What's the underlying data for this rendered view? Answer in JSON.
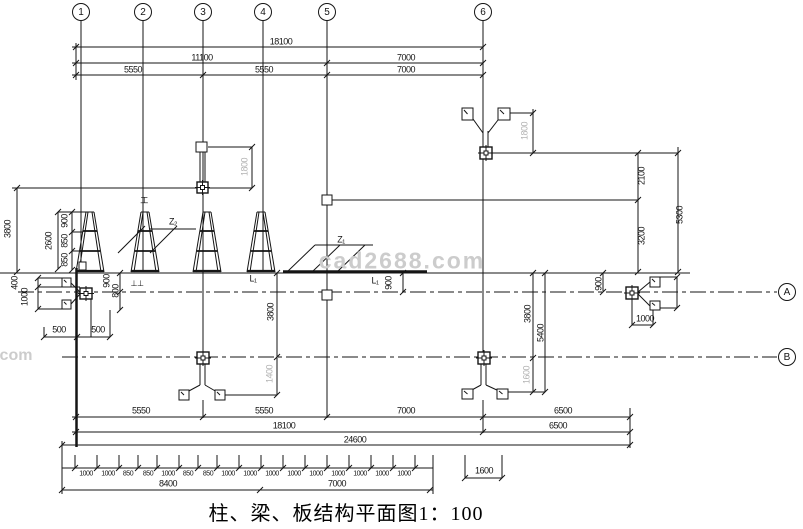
{
  "drawing_title": {
    "text": "柱、梁、板结构平面图1：100"
  },
  "watermark": {
    "main": "cad2688.com",
    "corner": "com"
  },
  "colors": {
    "line": "#151515",
    "dim_text": "#151515",
    "faint_dim_text": "#b3b3b3",
    "watermark": "#cccccc"
  },
  "grid": {
    "columns": [
      {
        "label": "1",
        "x": 81
      },
      {
        "label": "2",
        "x": 143
      },
      {
        "label": "3",
        "x": 203
      },
      {
        "label": "4",
        "x": 263
      },
      {
        "label": "5",
        "x": 327
      },
      {
        "label": "6",
        "x": 483
      }
    ],
    "rows": [
      {
        "label": "A",
        "y": 292
      },
      {
        "label": "B",
        "y": 357
      }
    ]
  },
  "dimension_labels": [
    {
      "t": "18100",
      "x": 281,
      "y": 42
    },
    {
      "t": "11100",
      "x": 202,
      "y": 58
    },
    {
      "t": "7000",
      "x": 406,
      "y": 58
    },
    {
      "t": "5550",
      "x": 133,
      "y": 70
    },
    {
      "t": "5550",
      "x": 264,
      "y": 70
    },
    {
      "t": "7000",
      "x": 406,
      "y": 70
    },
    {
      "t": "2100",
      "x": 642,
      "y": 176,
      "r": 1
    },
    {
      "t": "3200",
      "x": 642,
      "y": 236,
      "r": 1
    },
    {
      "t": "5300",
      "x": 680,
      "y": 215,
      "r": 1
    },
    {
      "t": "1800",
      "x": 525,
      "y": 131,
      "r": 1,
      "c": "gray"
    },
    {
      "t": "1800",
      "x": 245,
      "y": 167,
      "r": 1,
      "c": "gray"
    },
    {
      "t": "3800",
      "x": 8,
      "y": 229,
      "r": 1
    },
    {
      "t": "2600",
      "x": 49,
      "y": 241,
      "r": 1
    },
    {
      "t": "900",
      "x": 65,
      "y": 221,
      "r": 1
    },
    {
      "t": "850",
      "x": 65,
      "y": 241,
      "r": 1
    },
    {
      "t": "850",
      "x": 65,
      "y": 260,
      "r": 1
    },
    {
      "t": "400",
      "x": 15,
      "y": 283,
      "r": 1
    },
    {
      "t": "1000",
      "x": 25,
      "y": 297,
      "r": 1
    },
    {
      "t": "900",
      "x": 107,
      "y": 281,
      "r": 1
    },
    {
      "t": "800",
      "x": 116,
      "y": 291,
      "r": 1
    },
    {
      "t": "500",
      "x": 59,
      "y": 330
    },
    {
      "t": "500",
      "x": 98,
      "y": 330
    },
    {
      "t": "900",
      "x": 389,
      "y": 283,
      "r": 1
    },
    {
      "t": "3800",
      "x": 271,
      "y": 312,
      "r": 1
    },
    {
      "t": "1400",
      "x": 270,
      "y": 374,
      "r": 1,
      "c": "gray"
    },
    {
      "t": "3800",
      "x": 528,
      "y": 314,
      "r": 1
    },
    {
      "t": "5400",
      "x": 541,
      "y": 333,
      "r": 1
    },
    {
      "t": "1600",
      "x": 527,
      "y": 375,
      "r": 1,
      "c": "gray"
    },
    {
      "t": "900",
      "x": 599,
      "y": 284,
      "r": 1
    },
    {
      "t": "1000",
      "x": 645,
      "y": 319
    },
    {
      "t": "5550",
      "x": 141,
      "y": 411
    },
    {
      "t": "5550",
      "x": 264,
      "y": 411
    },
    {
      "t": "7000",
      "x": 406,
      "y": 411
    },
    {
      "t": "6500",
      "x": 563,
      "y": 411
    },
    {
      "t": "18100",
      "x": 284,
      "y": 426
    },
    {
      "t": "6500",
      "x": 558,
      "y": 426
    },
    {
      "t": "24600",
      "x": 355,
      "y": 440
    },
    {
      "t": "8400",
      "x": 168,
      "y": 484
    },
    {
      "t": "7000",
      "x": 337,
      "y": 484
    },
    {
      "t": "1600",
      "x": 484,
      "y": 471
    },
    {
      "t": "1000",
      "x": 86,
      "y": 474,
      "s": 7
    },
    {
      "t": "1000",
      "x": 108,
      "y": 474,
      "s": 7
    },
    {
      "t": "850",
      "x": 128,
      "y": 474,
      "s": 7
    },
    {
      "t": "850",
      "x": 148,
      "y": 474,
      "s": 7
    },
    {
      "t": "1000",
      "x": 168,
      "y": 474,
      "s": 7
    },
    {
      "t": "850",
      "x": 188,
      "y": 474,
      "s": 7
    },
    {
      "t": "850",
      "x": 208,
      "y": 474,
      "s": 7
    },
    {
      "t": "1000",
      "x": 228,
      "y": 474,
      "s": 7
    },
    {
      "t": "1000",
      "x": 250,
      "y": 474,
      "s": 7
    },
    {
      "t": "1000",
      "x": 272,
      "y": 474,
      "s": 7
    },
    {
      "t": "1000",
      "x": 294,
      "y": 474,
      "s": 7
    },
    {
      "t": "1000",
      "x": 316,
      "y": 474,
      "s": 7
    },
    {
      "t": "1000",
      "x": 338,
      "y": 474,
      "s": 7
    },
    {
      "t": "1000",
      "x": 360,
      "y": 474,
      "s": 7
    },
    {
      "t": "1000",
      "x": 382,
      "y": 474,
      "s": 7
    },
    {
      "t": "1000",
      "x": 404,
      "y": 474,
      "s": 7
    }
  ],
  "annotation_labels": [
    {
      "t": "Z₂",
      "x": 173,
      "y": 222
    },
    {
      "t": "Z₁",
      "x": 341,
      "y": 240
    },
    {
      "t": "L₁",
      "x": 253,
      "y": 279
    },
    {
      "t": "L₁",
      "x": 375,
      "y": 281
    },
    {
      "t": "工",
      "x": 144,
      "y": 201,
      "s": 8
    },
    {
      "t": "⊥⊥",
      "x": 137,
      "y": 284,
      "s": 8
    }
  ]
}
